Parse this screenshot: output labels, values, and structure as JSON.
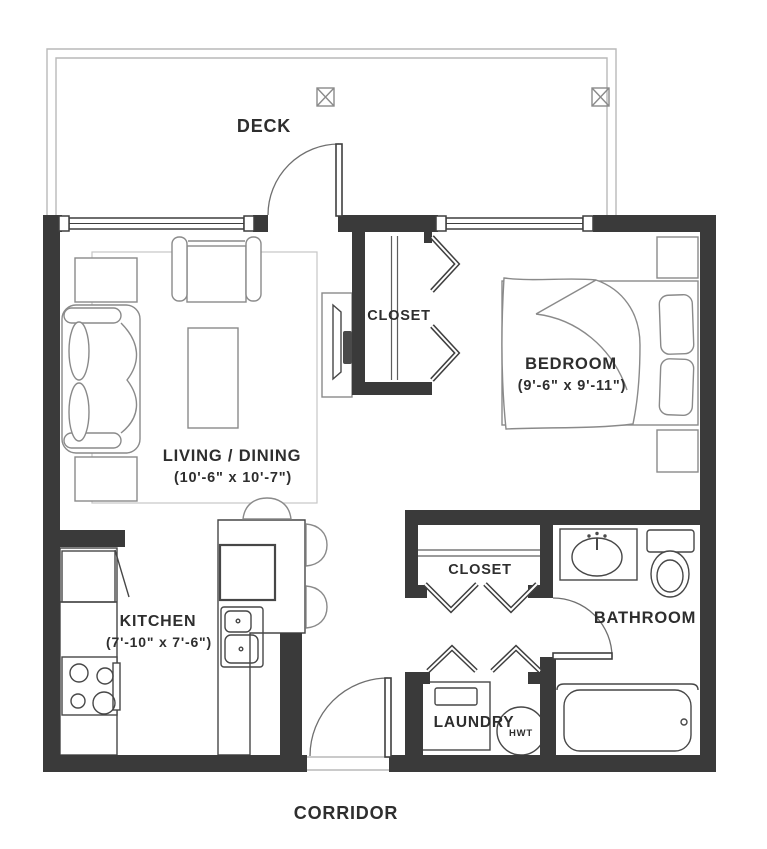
{
  "plan": {
    "type": "apartment-floor-plan",
    "colors": {
      "wall": "#3a3a3a",
      "fixture_line": "#474747",
      "furniture_line": "#8a8a8a",
      "light_line": "#b9b9b9",
      "text": "#2e2e2e",
      "background": "#ffffff"
    },
    "labels": {
      "deck": "DECK",
      "living": {
        "name": "LIVING / DINING",
        "dims": "(10'-6\" x 10'-7\")"
      },
      "bedroom": {
        "name": "BEDROOM",
        "dims": "(9'-6\" x 9'-11\")"
      },
      "kitchen": {
        "name": "KITCHEN",
        "dims": "(7'-10\" x 7'-6\")"
      },
      "closet_entry": "CLOSET",
      "closet_hall": "CLOSET",
      "bathroom": "BATHROOM",
      "laundry": "LAUNDRY",
      "hot_water_tank": "HWT",
      "corridor": "CORRIDOR"
    }
  }
}
